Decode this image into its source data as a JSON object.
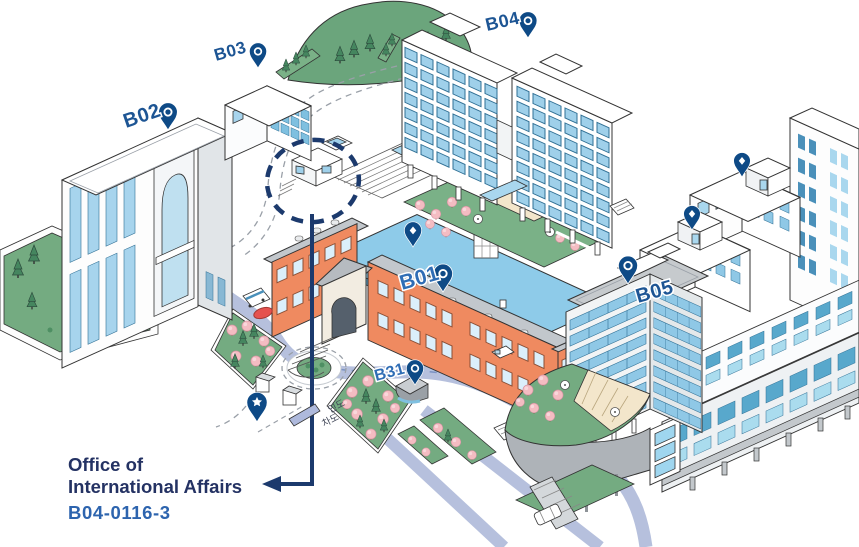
{
  "map": {
    "buildings": [
      {
        "label": "B01",
        "pin": "circle"
      },
      {
        "label": "B02",
        "pin": "circle"
      },
      {
        "label": "B03",
        "pin": "circle"
      },
      {
        "label": "B04",
        "pin": "circle"
      },
      {
        "label": "B05",
        "pin": "circle"
      },
      {
        "label": "B31",
        "pin": "circle"
      }
    ],
    "unlabeled_pins": [
      "diamond-pin-courtyard",
      "diamond-pin-northeast-building",
      "diamond-pin-east-building",
      "star-pin-plaza"
    ],
    "road_labels": {
      "sidewalk": "인도",
      "roadway": "차도"
    },
    "callout": {
      "office_line1": "Office of",
      "office_line2": "International Affairs",
      "room_code": "B04-0116-3"
    },
    "colors": {
      "pin_navy": "#0e4a86",
      "arrow_navy": "#1c3a6d",
      "label_blue": "#1d5594",
      "label_blue_bright": "#2f6db5",
      "callout_navy": "#243263",
      "code_blue": "#2d64ae",
      "road_lavender": "#b6c0dd",
      "window_blue": "#9fd0ea",
      "window_teal": "#58a8cc",
      "brick_orange": "#ef8a60",
      "roof_gray": "#c2c7cc",
      "lawn_green": "#74ab81",
      "tree_pink": "#f4bcc2",
      "deck_blue": "#8ecbe9",
      "hill_green": "#6ba57c"
    }
  }
}
